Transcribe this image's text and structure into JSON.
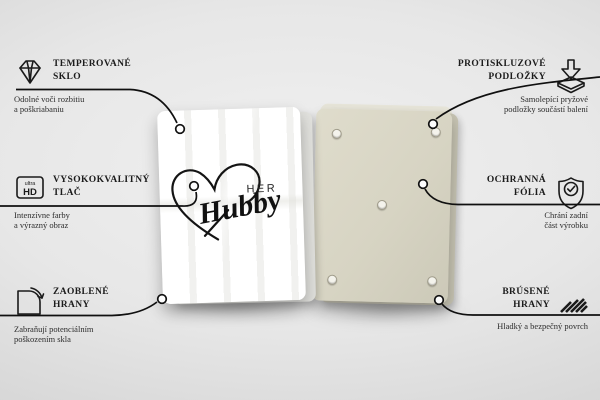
{
  "product": {
    "front_text_top": "HER",
    "front_text_script": "Hubby"
  },
  "callouts": {
    "left": [
      {
        "icon": "diamond-icon",
        "title1": "TEMPEROVANÉ",
        "title2": "SKLO",
        "desc1": "Odolné voči rozbitiu",
        "desc2": "a poškriabaniu"
      },
      {
        "icon": "ultra-hd-icon",
        "badge_small": "ultra",
        "badge_big": "HD",
        "title1": "VYSOKOKVALITNÝ",
        "title2": "TLAČ",
        "desc1": "Intenzívne farby",
        "desc2": "a výrazný obraz"
      },
      {
        "icon": "rounded-corner-icon",
        "title1": "ZAOBLENÉ",
        "title2": "HRANY",
        "desc1": "Zabraňují potenciálním",
        "desc2": "poškozením skla"
      }
    ],
    "right": [
      {
        "icon": "anti-slip-pad-icon",
        "title1": "PROTISKLUZOVÉ",
        "title2": "PODLOŽKY",
        "desc1": "Samolepící pryžové",
        "desc2": "podložky součástí balení"
      },
      {
        "icon": "shield-check-icon",
        "title1": "OCHRANNÁ",
        "title2": "FÓLIA",
        "desc1": "Chrání zadní",
        "desc2": "část výrobku"
      },
      {
        "icon": "ground-edges-icon",
        "title1": "BRÚSENÉ",
        "title2": "HRANY",
        "desc1": "Hladký a bezpečný povrch",
        "desc2": ""
      }
    ]
  },
  "colors": {
    "line": "#101010",
    "text": "#1c1c1c",
    "front_panel": "#ffffff",
    "back_panel": "#d7d4c3",
    "background": "#e4e4e4"
  }
}
